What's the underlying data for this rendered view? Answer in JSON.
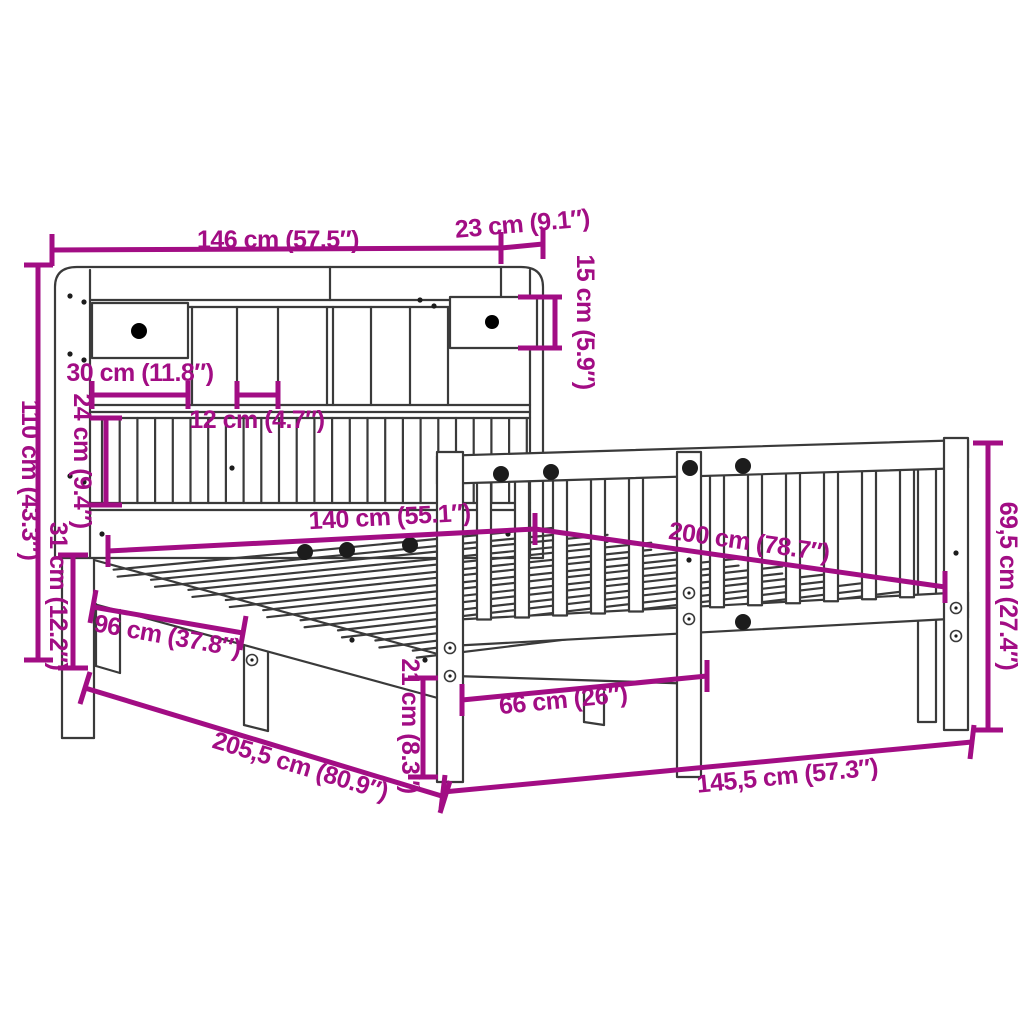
{
  "diagram": {
    "type": "product-dimension-diagram",
    "subject": "bookcase-headboard bed frame with side rail",
    "colors": {
      "dimension_accent": "#a20d84",
      "line_art": "#3a3a3a",
      "background": "#ffffff"
    },
    "dimensions": {
      "headboard_width": {
        "label": "146 cm (57.5″)"
      },
      "headboard_depth": {
        "label": "23 cm (9.1″)"
      },
      "cubby_height": {
        "label": "15 cm (5.9″)"
      },
      "headboard_height": {
        "label": "110 cm (43.3″)"
      },
      "drawer_width": {
        "label": "30 cm (11.8″)"
      },
      "slot_width": {
        "label": "12 cm (4.7″)"
      },
      "panel_height": {
        "label": "24 cm (9.4″)"
      },
      "base_height": {
        "label": "31 cm (12.2″)"
      },
      "mattress_width": {
        "label": "140 cm (55.1″)"
      },
      "mattress_length": {
        "label": "200 cm (78.7″)"
      },
      "rail_height": {
        "label": "69,5 cm (27.4″)"
      },
      "leg_spacing": {
        "label": "96 cm (37.8″)"
      },
      "total_length": {
        "label": "205,5 cm (80.9″)"
      },
      "leg_height": {
        "label": "21 cm (8.3″)"
      },
      "post_spacing": {
        "label": "66 cm (26″)"
      },
      "frame_width": {
        "label": "145,5 cm (57.3″)"
      }
    }
  }
}
